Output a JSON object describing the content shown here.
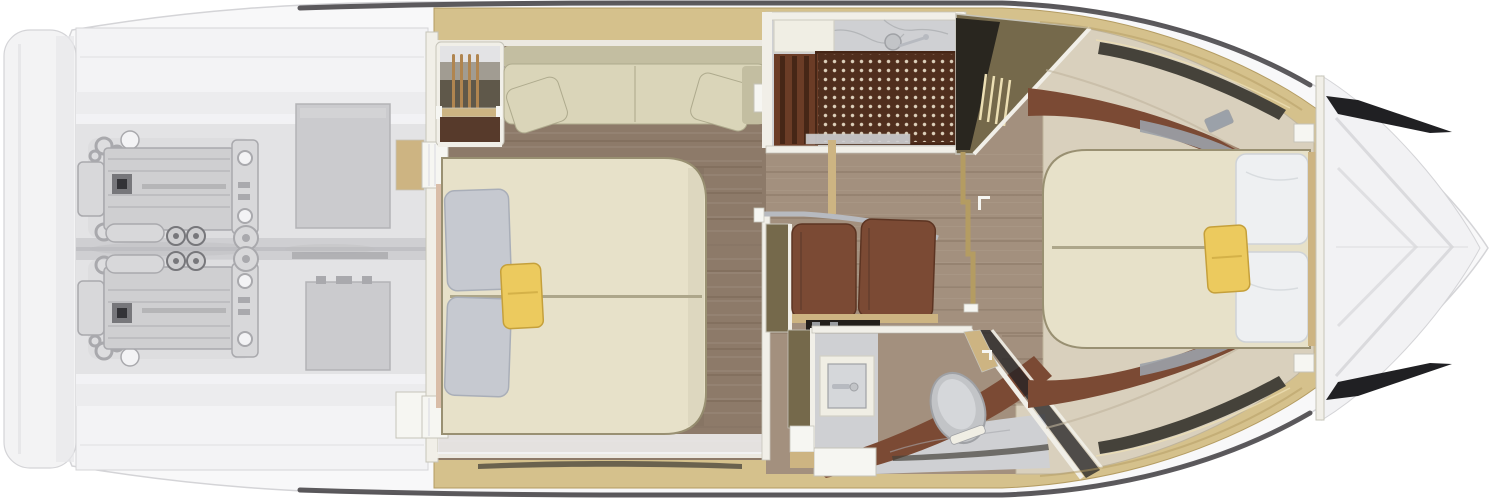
{
  "colors": {
    "hull": "#f8f8f9",
    "hull-edge": "#d4d4d7",
    "hull-shade": "#e7e7e9",
    "transom": "#f3f3f4",
    "rub": "#4a484b",
    "er-band": "#f3f3f5",
    "er-floor": "#ececee",
    "er-mid": "#e3e3e5",
    "keel": "#cfcfd2",
    "keel-dark": "#bcbcc0",
    "eng-light": "#d8d8da",
    "eng-body": "#cfcfd1",
    "eng-mid": "#a9a9ad",
    "eng-dark": "#77777b",
    "eng-black": "#333337",
    "equip": "#cbcbce",
    "equip-edge": "#b3b3b6",
    "gold": "#d5c18c",
    "gold-deep": "#b49c62",
    "gold-hi": "#ecdfb4",
    "gold-sill": "#cdb482",
    "bow-deck": "#f2f2f4",
    "bow-line": "#d7d7da",
    "vent": "#202023",
    "slit": "#45423a",
    "wall": "#f1efe8",
    "wall-edge": "#c6c4b9",
    "wood-master": "#8d7a69",
    "wood-light": "#a3907e",
    "bed": "#e7e1c9",
    "bed-edge": "#999072",
    "bed-seam": "#ada68a",
    "pillow-gray": "#c6c9d0",
    "pillow-gray-edge": "#a9aeb8",
    "pillow-white": "#eef0f2",
    "pillow-white-edge": "#cfd3d7",
    "yellow": "#ecca5e",
    "yellow-edge": "#c5a03b",
    "sofa": "#dad5b9",
    "sofa-dark": "#c3bea1",
    "sofa-edge": "#aeaa8d",
    "headboard": "#d9bda8",
    "wardrobe": "#5f584a",
    "ward-deep": "#29261f",
    "hanger": "#b08550",
    "olive": "#75694b",
    "marble": "#cfd0d3",
    "marble-vein": "#a7a9ad",
    "teak": "#502e1d",
    "slat": "#6b3c26",
    "slat-dark": "#462616",
    "leather": "#7b4a34",
    "leather-dark": "#5c3422",
    "beige": "#d9d0bd",
    "beige-edge": "#bfb49c",
    "gray-acc": "#9ba1a9",
    "fixture": "#f0eee4",
    "fixture-edge": "#d3d1c5",
    "toilet": "#c2c4c7",
    "toilet-edge": "#9fa1a5",
    "toilet-inner": "#d5d7da",
    "soffit": "#221e1a",
    "chrome": "#b7bac0",
    "white-box": "#f6f6f2"
  },
  "sections": [
    "swim-platform",
    "engine-room",
    "master-cabin",
    "shower-room",
    "corridor-lobby",
    "head-bathroom",
    "forward-cabin",
    "bow-deck"
  ],
  "components": {
    "engine-room": [
      "port-engine",
      "starboard-engine",
      "fuel-tank",
      "generator-box"
    ],
    "master-cabin": [
      "double-bed",
      "sofa",
      "hanging-wardrobe",
      "pillows",
      "yellow-cushion"
    ],
    "shower-room": [
      "teak-grate",
      "shower-bench",
      "shower-wand",
      "marble-floor"
    ],
    "head-bathroom": [
      "sink-vanity",
      "toilet",
      "curved-counter",
      "angled-door"
    ],
    "forward-cabin": [
      "island-bed",
      "white-pillows",
      "yellow-cushion",
      "wardrobe-closet",
      "side-benches"
    ],
    "bow-deck": [
      "deck-vents",
      "chevron-moldings"
    ]
  }
}
